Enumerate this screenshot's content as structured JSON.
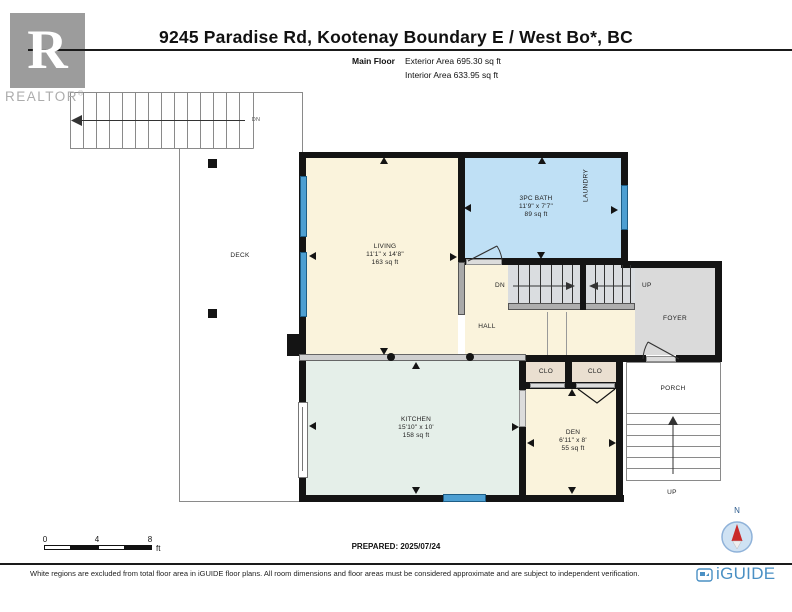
{
  "header": {
    "title": "9245 Paradise Rd, Kootenay Boundary E / West Bo*, BC",
    "floor_label": "Main Floor",
    "exterior_area": "Exterior Area 695.30 sq ft",
    "interior_area": "Interior Area 633.95 sq ft"
  },
  "realtor": {
    "letter": "R",
    "wordmark": "REALTOR",
    "reg": "®"
  },
  "plan": {
    "rooms": {
      "living": {
        "name": "LIVING",
        "dims": "11'1\" x 14'8\"",
        "area": "163 sq ft"
      },
      "bath": {
        "name": "3PC BATH",
        "dims": "11'9\" x 7'7\"",
        "area": "89 sq ft"
      },
      "kitchen": {
        "name": "KITCHEN",
        "dims": "15'10\" x 10'",
        "area": "158 sq ft"
      },
      "den": {
        "name": "DEN",
        "dims": "6'11\" x 8'",
        "area": "55 sq ft"
      }
    },
    "labels": {
      "hall": "HALL",
      "foyer": "FOYER",
      "porch": "PORCH",
      "deck": "DECK",
      "laundry": "LAUNDRY",
      "closet1": "CLO",
      "closet2": "CLO",
      "stairs_down": "DN",
      "stairs_up": "UP",
      "deck_stairs_down": "DN",
      "porch_stairs_up": "UP"
    }
  },
  "scale_bar": {
    "tick0": "0",
    "tick1": "4",
    "tick2": "8",
    "unit": "ft"
  },
  "prepared": "PREPARED: 2025/07/24",
  "compass": {
    "north": "N"
  },
  "footer": {
    "disclaimer": "White regions are excluded from total floor area in iGUIDE floor plans. All room dimensions and floor areas must be considered approximate and are subject to independent verification.",
    "brand": "iGUIDE"
  },
  "colors": {
    "room_cream": "#FAF3DC",
    "bath_blue": "#BFE0F5",
    "kitchen_mint": "#E5EFE9",
    "foyer_gray": "#DADADA",
    "closet_tan": "#EADFD0",
    "window_blue": "#4D9FD2",
    "wall_black": "#141414",
    "brand_blue": "#4A90C4",
    "compass_red": "#C92A2A"
  }
}
